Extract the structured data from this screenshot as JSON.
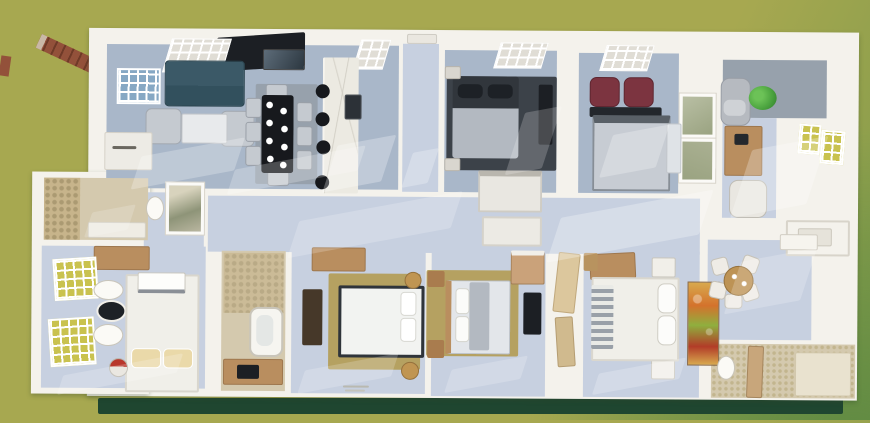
{
  "meta": {
    "title": "3D rendered top-view floor plan of a multi-bedroom house on a green lawn",
    "view": "aerial-3d-render",
    "visible_text": "none (only tiny illegible stamp marks on floor edge)"
  },
  "palette": {
    "grass": "#a7a850",
    "grass_edge": "#7f9a4a",
    "grass_deep": "#5f8a42",
    "grass_shadow": "#1f4630",
    "wall": "#f4f2ec",
    "wall_shadow": "#ddd9d0",
    "floor_cool": "#a9b7c9",
    "floor_pale": "#c7d0e0",
    "floor_gray": "#97a1ac",
    "tile": "#d4c9ae",
    "pebble": "#c7b48b",
    "marble": "#eceae2",
    "rug_dark": "#3c4249",
    "rug_tan": "#b5a161",
    "sofa": "#3b5967",
    "seat_gray": "#c5cad0",
    "table_dark": "#17191d",
    "tv": "#1c1f24",
    "maroon": "#7c3440",
    "wood": "#b98e5f",
    "wood_dark": "#463829",
    "bed_white": "#f0efe9",
    "blanket": "#b3b9c1",
    "pillow_dark": "#1d2126",
    "pillow_cream": "#ead9a9",
    "art_green": "#9aa381",
    "art_orange": "#d4722c",
    "art_lime": "#8faf3e",
    "art_gold": "#d8a94e",
    "art_red": "#b23c28",
    "plant": "#4aa23e",
    "window_yellow": "#c9c24f",
    "window_blue": "#86a8c4",
    "brick": "#93513a",
    "accent_red": "#b8372c"
  },
  "rooms": [
    {
      "id": "living-room",
      "name": "Living room",
      "furniture": [
        "teal sofa",
        "two gray armchairs",
        "coffee table",
        "wall TV",
        "sideboard",
        "blue window"
      ]
    },
    {
      "id": "dining-area",
      "name": "Dining area",
      "furniture": [
        "black 8-seat dining table with white plates",
        "gray area rug"
      ]
    },
    {
      "id": "kitchen",
      "name": "Kitchen",
      "furniture": [
        "marble island",
        "four black bar stools",
        "dark sink"
      ]
    },
    {
      "id": "entry-hall",
      "name": "Entry hall",
      "furniture": [
        "front door"
      ]
    },
    {
      "id": "bedroom-top-center",
      "name": "Bedroom (top center)",
      "furniture": [
        "dark double bed",
        "dark rug",
        "wall TV",
        "closet",
        "two nightstands"
      ]
    },
    {
      "id": "bedroom-top-right",
      "name": "Bedroom (top right)",
      "furniture": [
        "double bed",
        "two maroon armchairs",
        "dark console",
        "two wall artworks",
        "side desk"
      ]
    },
    {
      "id": "study",
      "name": "Study / home office",
      "furniture": [
        "wood desk",
        "laptop",
        "office chair",
        "gray chaise",
        "green plant",
        "two yellow windows",
        "wall niche"
      ]
    },
    {
      "id": "bathroom-left-wing",
      "name": "Bathroom (left wing)",
      "furniture": [
        "pebble shower wall",
        "tiled floor"
      ]
    },
    {
      "id": "bedroom-bottom-left",
      "name": "Bedroom (bottom left)",
      "furniture": [
        "white double bed",
        "cream pillows",
        "wood desk",
        "two yellow windows",
        "laundry basket"
      ]
    },
    {
      "id": "wc",
      "name": "WC",
      "furniture": [
        "black-lid toilet",
        "two basins"
      ]
    },
    {
      "id": "powder-room",
      "name": "Powder room",
      "furniture": [
        "toilet",
        "wall art"
      ]
    },
    {
      "id": "bathroom-center",
      "name": "Bathroom (center)",
      "furniture": [
        "bathtub",
        "wood vanity",
        "dark mirror",
        "pebble floor"
      ]
    },
    {
      "id": "bedroom-bottom-center",
      "name": "Bedroom (bottom center)",
      "furniture": [
        "white double bed",
        "tan rug",
        "dark wardrobe",
        "desk",
        "two drum stools"
      ]
    },
    {
      "id": "bedroom-bottom-middle",
      "name": "Bedroom (bottom middle)",
      "furniture": [
        "double bed",
        "tan rug",
        "two wood nightstands",
        "dresser",
        "wall TV",
        "open wood doors"
      ]
    },
    {
      "id": "bedroom-bottom-right",
      "name": "Bedroom (bottom right)",
      "furniture": [
        "white double bed",
        "striped runner",
        "two white nightstands",
        "wood headboard panel",
        "colorful abstract art"
      ]
    },
    {
      "id": "breakfast-nook",
      "name": "Breakfast nook",
      "furniture": [
        "round wood table",
        "five white chairs",
        "basin counter"
      ]
    },
    {
      "id": "bathroom-bottom-right",
      "name": "Bathroom (bottom right)",
      "furniture": [
        "toilet",
        "patterned tile walls",
        "wood partition"
      ]
    },
    {
      "id": "corridor",
      "name": "Central corridor",
      "furniture": [
        "storage closets",
        "sunlight patches"
      ]
    }
  ],
  "exterior": {
    "features": [
      "olive green lawn",
      "dark shadow strip under house",
      "diagonal brick beam at top-left corner",
      "small brick fragment at left edge"
    ]
  }
}
